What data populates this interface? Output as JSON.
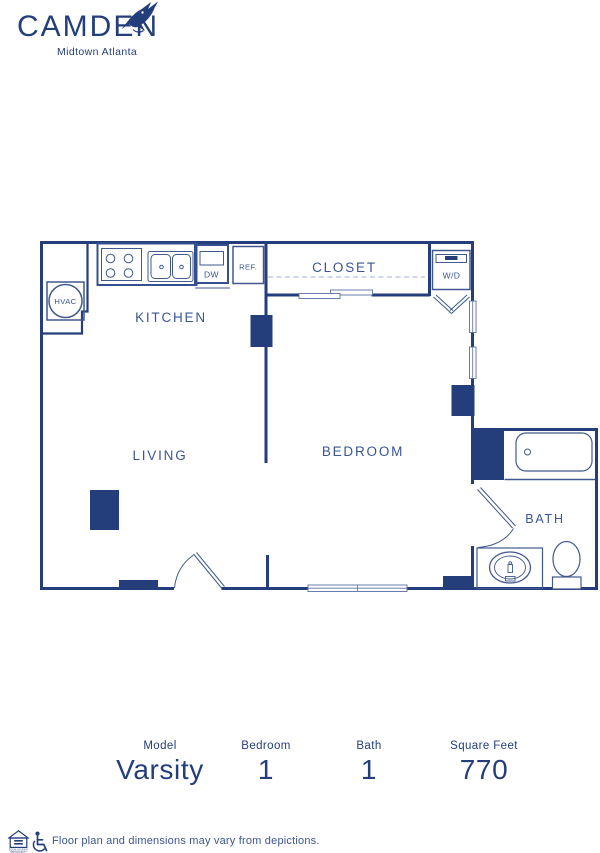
{
  "brand": {
    "name": "CAMDEN",
    "location": "Midtown Atlanta",
    "color": "#233E7B"
  },
  "plan": {
    "labels": {
      "kitchen": "KITCHEN",
      "living": "LIVING",
      "bedroom": "BEDROOM",
      "closet": "CLOSET",
      "bath": "BATH",
      "hvac": "HVAC",
      "washer_dryer": "W/D",
      "dishwasher": "DW",
      "refrigerator": "REF."
    },
    "colors": {
      "wall": "#233E7B",
      "room_label": "#3A5694",
      "fixture": "#41598F"
    }
  },
  "summary": [
    {
      "label": "Model",
      "value": "Varsity"
    },
    {
      "label": "Bedroom",
      "value": "1"
    },
    {
      "label": "Bath",
      "value": "1"
    },
    {
      "label": "Square Feet",
      "value": "770"
    }
  ],
  "footer": {
    "disclaimer": "Floor plan and dimensions may vary from depictions.",
    "equal_housing_line1": "EQUAL HOUSING",
    "equal_housing_line2": "OPPORTUNITY"
  }
}
